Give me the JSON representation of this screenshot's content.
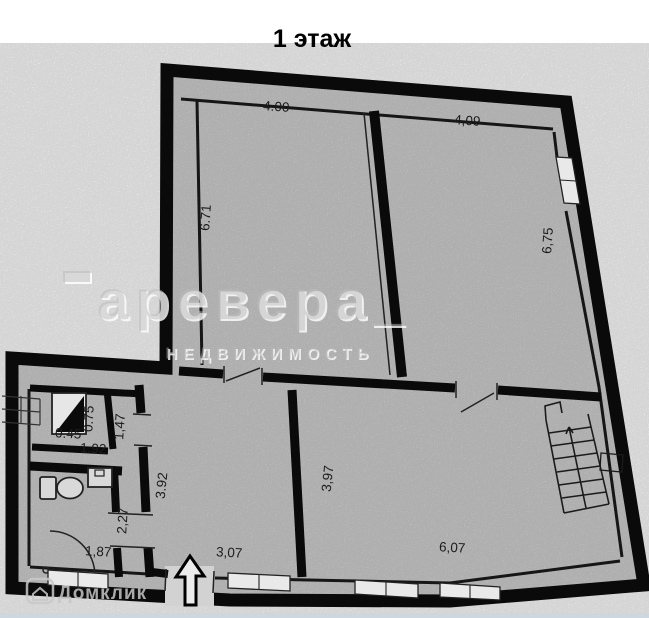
{
  "title": "1 этаж",
  "watermark": {
    "brand": "аревера_",
    "brand_sub": "НЕДВИЖИМОСТЬ",
    "portal": "Домклик"
  },
  "colors": {
    "paper": "#ffffff",
    "floor": "#d2d2d2",
    "walls": "#0a0a0a",
    "watermark_gray": "#c9c9c9",
    "portal_gray": "#c5c5c5",
    "footer_strip": "#ccd7e0"
  },
  "icons": {
    "entrance_arrow": "up-arrow",
    "toilet": "toilet-bowl",
    "sink": "sink",
    "ventilation_shaft": "half-filled-triangle",
    "staircase": "stairs-with-direction-line",
    "door_swing": "quarter-arc",
    "exterior_steps": "hatch-grid"
  },
  "dimensions": {
    "room_top_left": {
      "width": "4.00",
      "height": "6.71"
    },
    "room_top_right": {
      "width": "4,09",
      "height": "6,75"
    },
    "shaft": {
      "width": "0.45",
      "height": "0.75"
    },
    "shaft_room_width": "1.92",
    "hall_strip_height": "1,47",
    "corridor_height": "3.92",
    "passage_height": "2,27",
    "wc_width": "1,87",
    "entry_corridor_width": "3,07",
    "hall_room": {
      "height": "3,97",
      "width": "6,07"
    }
  }
}
